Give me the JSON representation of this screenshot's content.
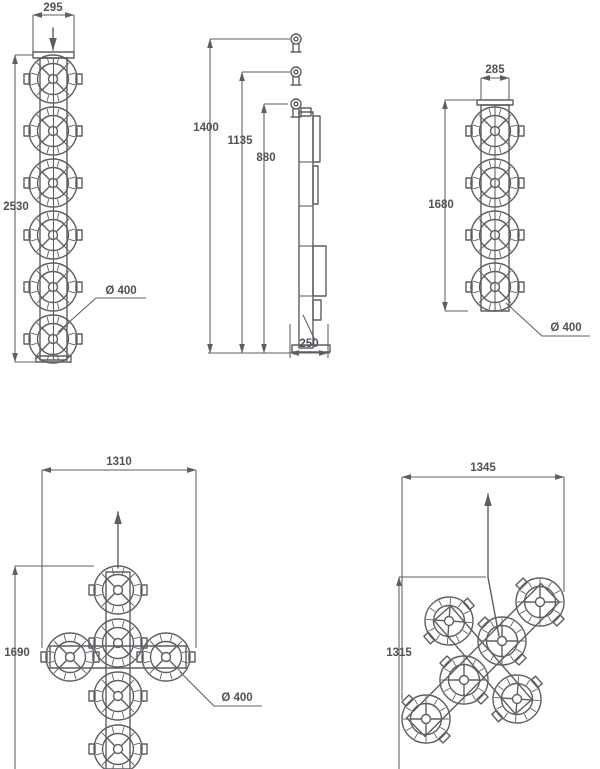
{
  "colors": {
    "line": "#5d5d63",
    "text": "#515158",
    "background": "#ffffff"
  },
  "figures": {
    "front_six_lamp": {
      "width": "295",
      "height": "2530",
      "diameter": "Ø 400",
      "lamp_count": 6
    },
    "side_view": {
      "dim_full": "1400",
      "dim_mid": "1135",
      "dim_lower": "880",
      "depth": "250"
    },
    "front_four_lamp": {
      "width": "285",
      "height": "1680",
      "diameter": "Ø 400",
      "lamp_count": 4
    },
    "cross_upright": {
      "width": "1310",
      "height": "1690",
      "diameter": "Ø 400",
      "lamp_count": 6
    },
    "cross_tilted": {
      "width": "1345",
      "height": "1315",
      "lamp_count": 6
    }
  }
}
